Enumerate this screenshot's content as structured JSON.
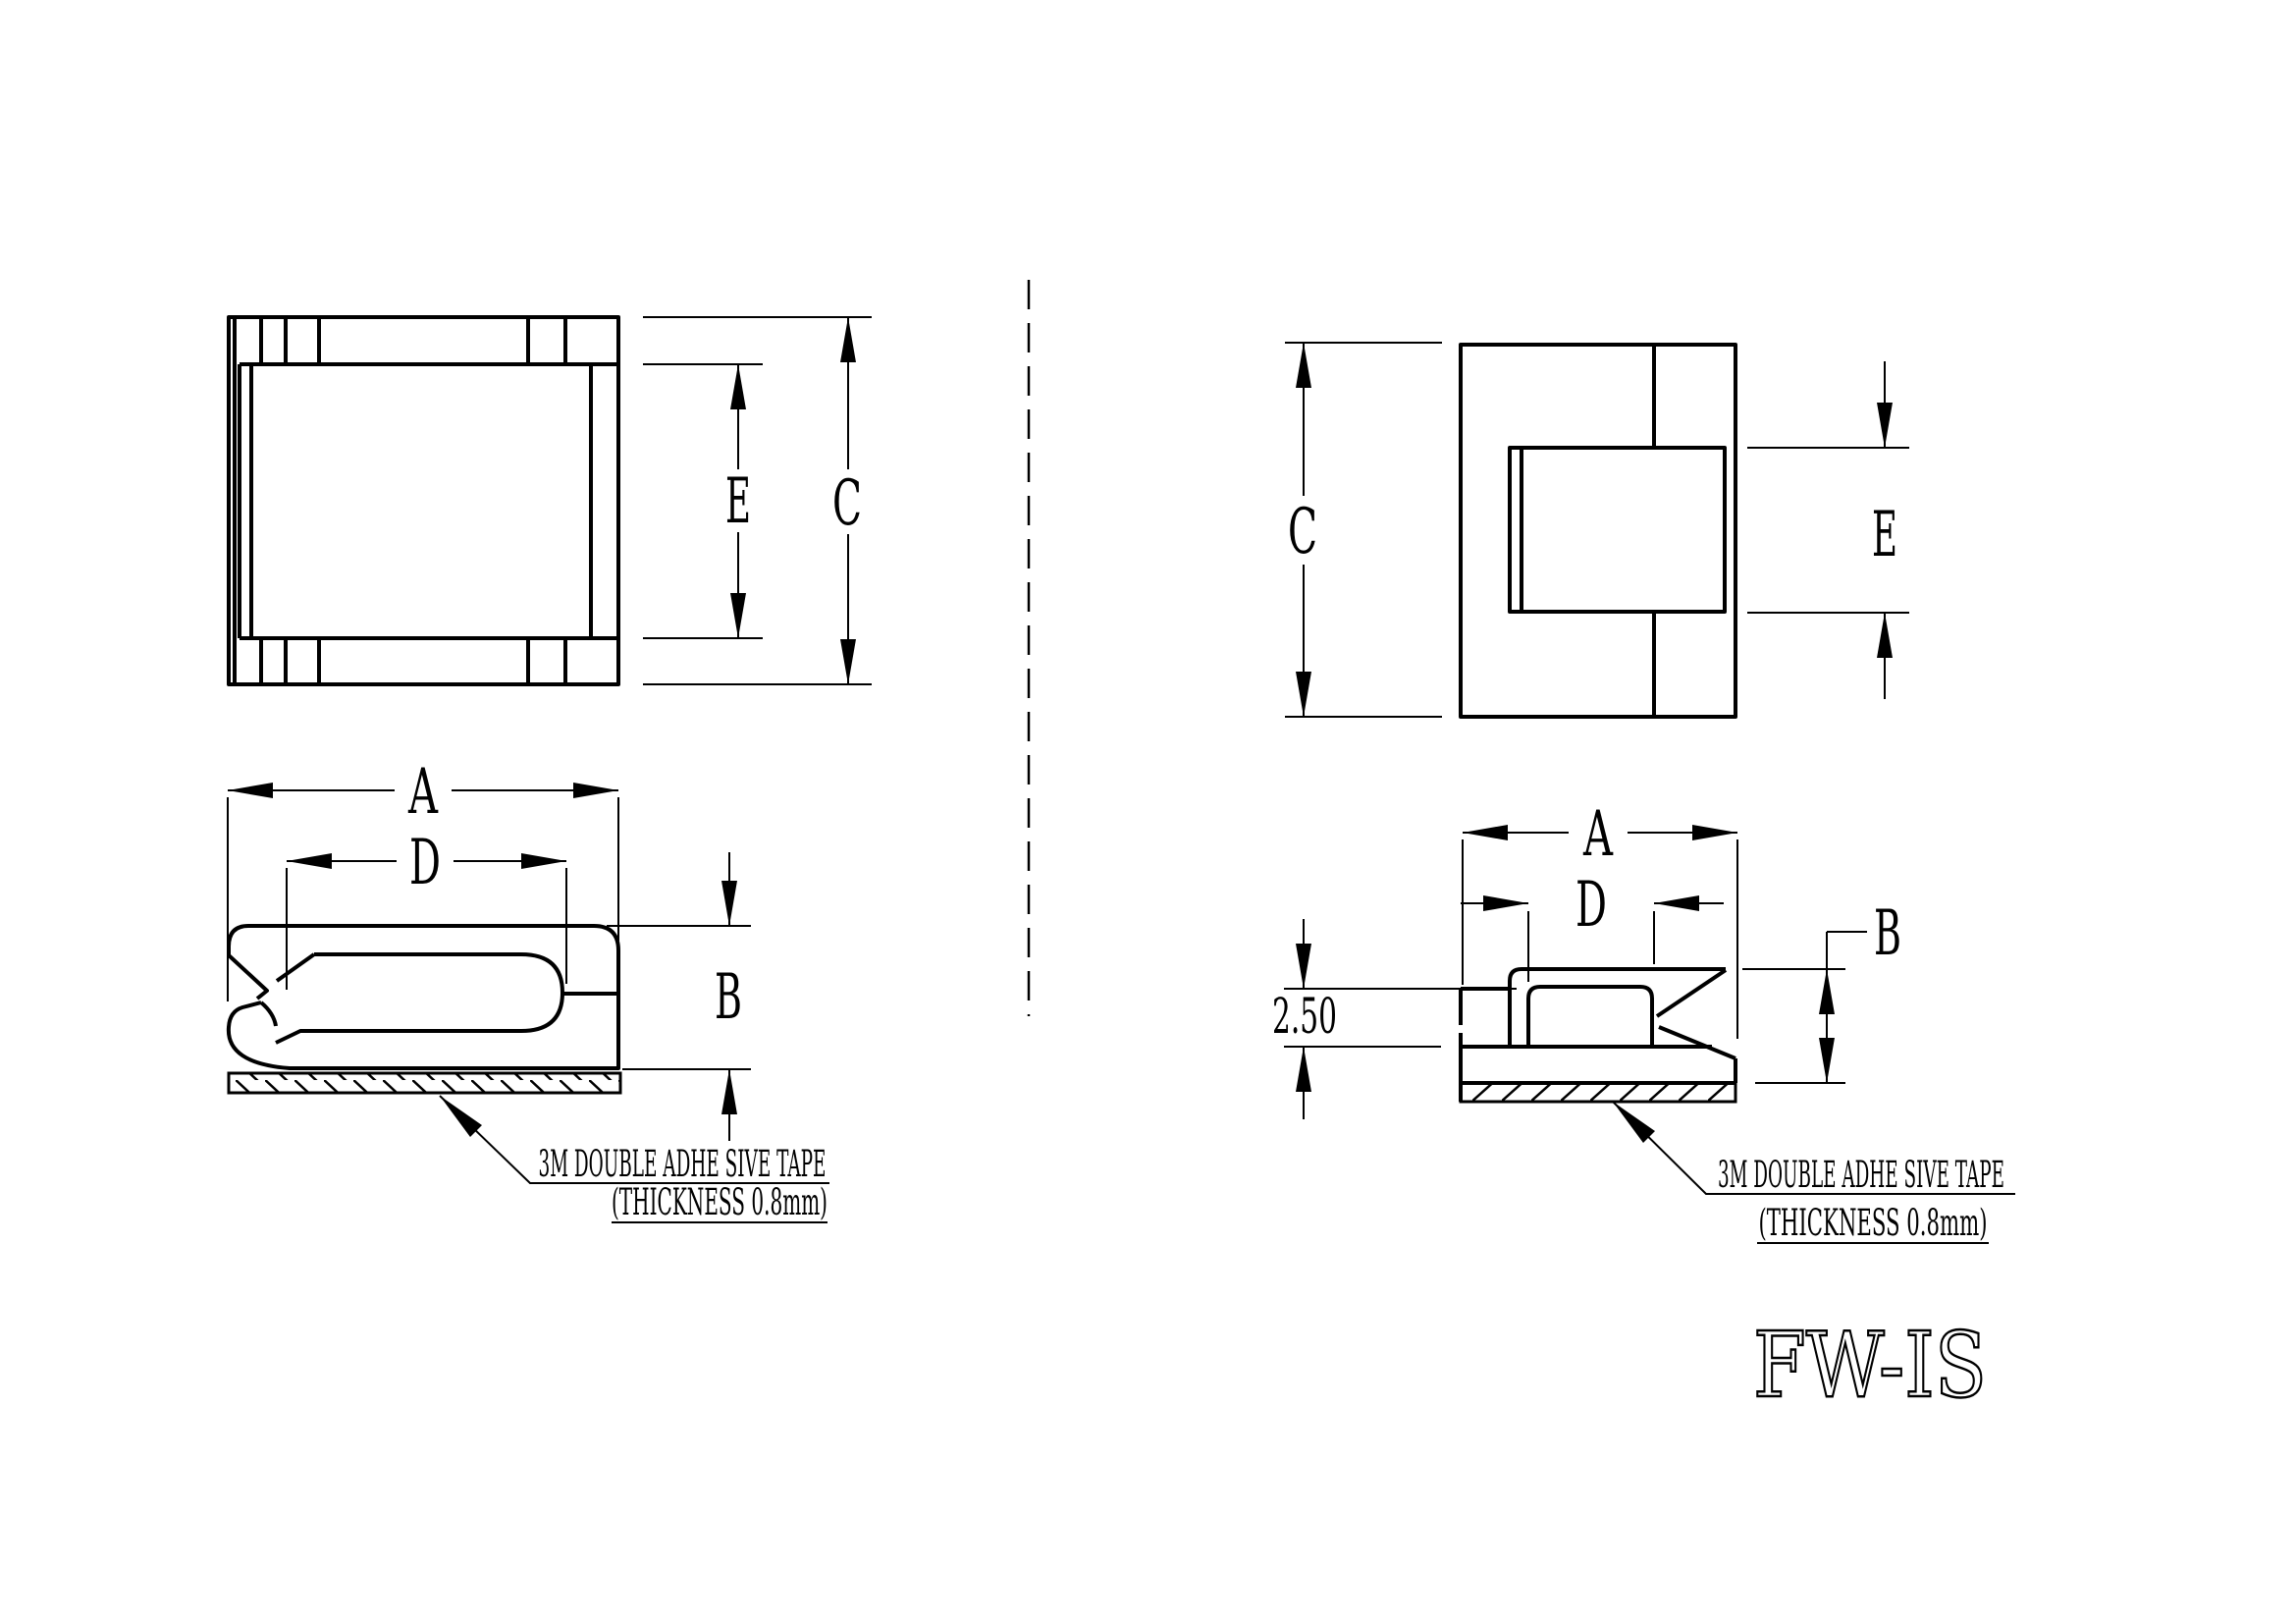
{
  "title": "FW-IS",
  "colors": {
    "line": "#000000",
    "background": "#ffffff"
  },
  "left_view": {
    "dims": {
      "a": "A",
      "b": "B",
      "c": "C",
      "d": "D",
      "e": "E"
    },
    "tape_note": {
      "line1": "3M DOUBLE ADHE SIVE TAPE",
      "line2": "(THICKNESS 0.8mm)"
    }
  },
  "right_view": {
    "dims": {
      "a": "A",
      "b": "B",
      "c": "C",
      "d": "D",
      "e": "E",
      "wall_height": "2.50"
    },
    "tape_note": {
      "line1": "3M DOUBLE ADHE SIVE TAPE",
      "line2": "(THICKNESS 0.8mm)"
    }
  }
}
